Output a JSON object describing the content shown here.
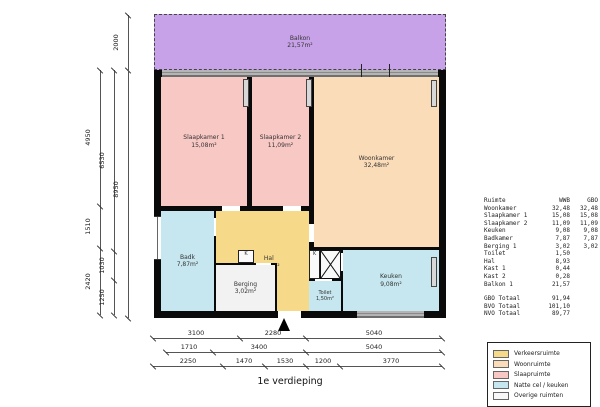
{
  "title": "1e verdieping",
  "rooms": {
    "balkon": {
      "name": "Balkon",
      "area": "21,57m²"
    },
    "slaapkamer1": {
      "name": "Slaapkamer 1",
      "area": "15,08m²"
    },
    "slaapkamer2": {
      "name": "Slaapkamer 2",
      "area": "11,09m²"
    },
    "woonkamer": {
      "name": "Woonkamer",
      "area": "32,48m²"
    },
    "badkamer": {
      "name": "Badk",
      "area": "7,87m²"
    },
    "hal": {
      "name": "Hal",
      "area": "8,93m²"
    },
    "berging": {
      "name": "Berging",
      "area": "3,02m²"
    },
    "toilet": {
      "name": "Toilet",
      "area": "1,50m²"
    },
    "keuken": {
      "name": "Keuken",
      "area": "9,08m²"
    },
    "kast_label": "K"
  },
  "area_table": {
    "headers": [
      "Ruimte",
      "WWB",
      "GBO"
    ],
    "rows": [
      [
        "Woonkamer",
        "32,48",
        "32,48"
      ],
      [
        "Slaapkamer 1",
        "15,08",
        "15,08"
      ],
      [
        "Slaapkamer 2",
        "11,09",
        "11,09"
      ],
      [
        "Keuken",
        "9,08",
        "9,08"
      ],
      [
        "Badkamer",
        "7,87",
        "7,87"
      ],
      [
        "Berging 1",
        "3,02",
        "3,02"
      ],
      [
        "Toilet",
        "1,50",
        ""
      ],
      [
        "Hal",
        "8,93",
        ""
      ],
      [
        "Kast 1",
        "0,44",
        ""
      ],
      [
        "Kast 2",
        "0,28",
        ""
      ],
      [
        "Balkon 1",
        "21,57",
        ""
      ]
    ],
    "totals": [
      [
        "GBO Totaal",
        "91,94"
      ],
      [
        "BVO Totaal",
        "101,10"
      ],
      [
        "NVO Totaal",
        "89,77"
      ]
    ]
  },
  "legend": {
    "items": [
      {
        "label": "Verkeersruimte",
        "color": "#f6da8a"
      },
      {
        "label": "Woonruimte",
        "color": "#fbdcb8"
      },
      {
        "label": "Slaapruimte",
        "color": "#f8c8c4"
      },
      {
        "label": "Natte cel / keuken",
        "color": "#c6e7ef"
      },
      {
        "label": "Overige ruimten",
        "color": "#f8f8f8"
      }
    ]
  },
  "colors": {
    "balkon": "#c8a2e8",
    "slaapruimte": "#f8c8c4",
    "woonruimte": "#fbdcb8",
    "verkeersruimte": "#f6da8a",
    "natte_cel": "#c6e7ef",
    "overig": "#f2f2f2",
    "wall": "#0a0a0a"
  },
  "dimensions": {
    "balcony_height": "2000",
    "left_col1": [
      "4950",
      "1510",
      "2420"
    ],
    "left_col2": [
      "6530",
      "1030",
      "1250"
    ],
    "left_col3": [
      "8950"
    ],
    "bottom_row1": [
      "3100",
      "2280",
      "5040"
    ],
    "bottom_row2": [
      "1710",
      "3400",
      "5040"
    ],
    "bottom_row3": [
      "2250",
      "1470",
      "1530",
      "1200",
      "3770"
    ]
  }
}
